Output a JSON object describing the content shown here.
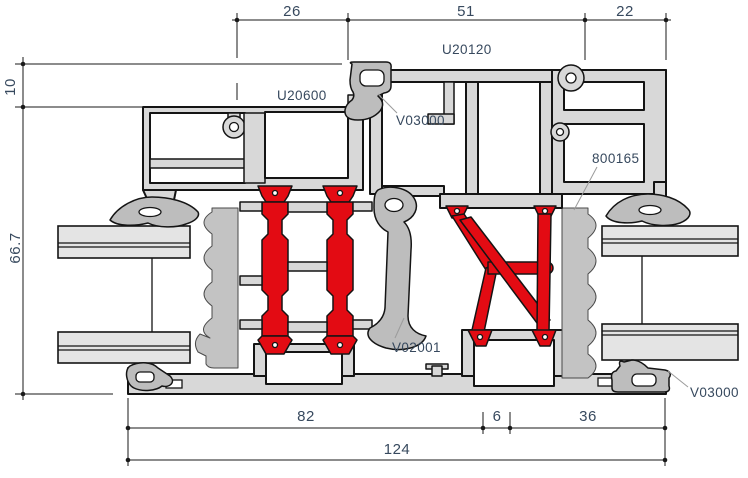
{
  "drawing": {
    "type": "aluminium window profile cross-section",
    "dims": {
      "top_26": "26",
      "top_51": "51",
      "top_22": "22",
      "left_10": "10",
      "left_667": "66.7",
      "bot_82": "82",
      "bot_6": "6",
      "bot_36": "36",
      "bot_124": "124"
    },
    "labels": {
      "u20600": "U20600",
      "u20120": "U20120",
      "v03000_top": "V03000",
      "p800165": "800165",
      "v02001": "V02001",
      "v03000_bottom": "V03000"
    },
    "colors": {
      "aluminium_fill": "#d8d8d8",
      "thermal_break_red": "#e30b13",
      "gasket_grey": "#bdbdbd",
      "foam_grey": "#c3c3c3",
      "outline": "#141414",
      "text": "#37495e",
      "leader_line": "#9b9b9b",
      "background": "#ffffff"
    }
  }
}
